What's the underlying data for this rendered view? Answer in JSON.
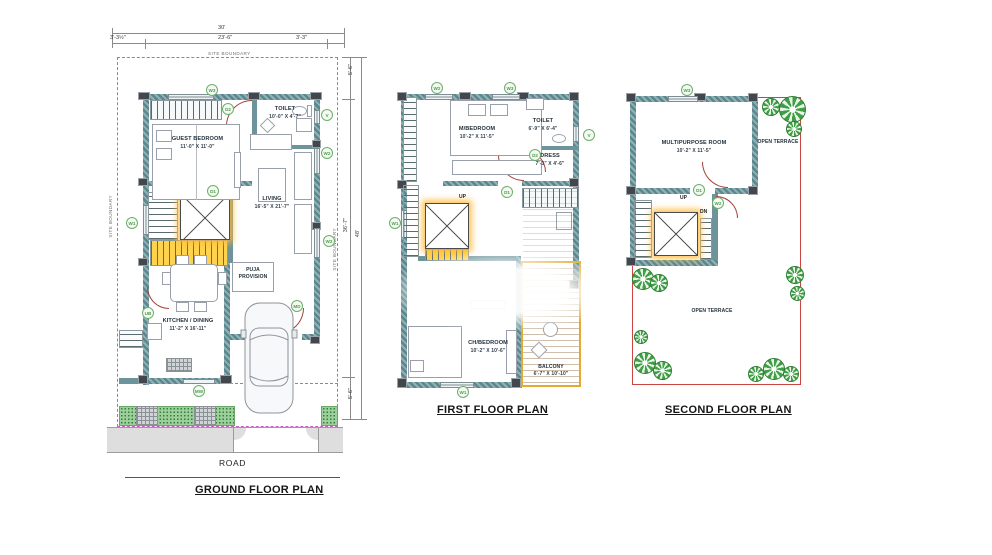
{
  "ground_floor": {
    "title": "GROUND FLOOR PLAN",
    "road": "ROAD",
    "site_boundary_top": "SITE BOUNDARY",
    "site_boundary_left": "SITE BOUNDARY",
    "site_boundary_right": "SITE BOUNDARY",
    "dims": {
      "total_width": "30'",
      "left_margin": "3'-3½\"",
      "inner_width": "23'-6\"",
      "right_margin": "3'-3\"",
      "front_margin": "5'-6\"",
      "inner_depth": "36'-7\"",
      "total_depth": "48'",
      "rear_margin": "5'-6\""
    },
    "rooms": {
      "guest_bedroom": {
        "name": "GUEST BEDROOM",
        "size": "11'-0\" X 11'-0\""
      },
      "toilet": {
        "name": "TOILET",
        "size": "10'-0\" X 4'-7\""
      },
      "living": {
        "name": "LIVING",
        "size": "16'-5\" X 21'-7\""
      },
      "puja": {
        "name": "PUJA PROVISION",
        "size": ""
      },
      "kitchen": {
        "name": "KITCHEN / DINING",
        "size": "11'-2\" X 16'-11\""
      }
    },
    "stairs": {
      "up": "UP"
    },
    "tags": [
      "W3",
      "D2",
      "V",
      "W2",
      "W2",
      "D1",
      "W1",
      "UB",
      "MD",
      "MW"
    ]
  },
  "first_floor": {
    "title": "FIRST FLOOR PLAN",
    "rooms": {
      "master_bedroom": {
        "name": "M/BEDROOM",
        "size": "10'-2\" X 11'-5\""
      },
      "toilet": {
        "name": "TOILET",
        "size": "6'-9\" X 6'-4\""
      },
      "dress": {
        "name": "DRESS",
        "size": "7'-3\" X 4'-6\""
      },
      "child_bedroom": {
        "name": "CH/BEDROOM",
        "size": "10'-2\" X 10'-6\""
      },
      "balcony": {
        "name": "BALCONY",
        "size": "6'-7\" X 10'-10\""
      }
    },
    "stairs": {
      "up": "UP"
    },
    "tags": [
      "W2",
      "W3",
      "V",
      "D2",
      "D1",
      "W1",
      "W1"
    ]
  },
  "second_floor": {
    "title": "SECOND FLOOR PLAN",
    "rooms": {
      "multipurpose": {
        "name": "MULTIPURPOSE ROOM",
        "size": "10'-2\" X 11'-5\""
      },
      "terrace_right": {
        "name": "OPEN TERRACE"
      },
      "terrace_main": {
        "name": "OPEN TERRACE"
      }
    },
    "stairs": {
      "up": "UP",
      "dn": "DN"
    },
    "tags": [
      "W3",
      "D1",
      "W2"
    ]
  },
  "colors": {
    "wall": "#5d868d",
    "door_swing": "#a2423a",
    "tag_green": "#5ea95e",
    "site_boundary": "#c75fc7",
    "stair_highlight": "#ffd34d",
    "balcony_frame": "#e4a92f",
    "terrace_line": "#cc4444",
    "tree_green": "#3f9e46"
  }
}
